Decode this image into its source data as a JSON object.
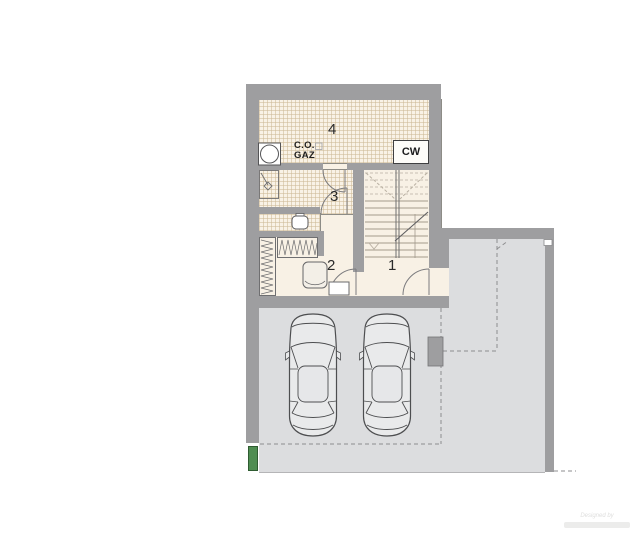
{
  "floor_plan": {
    "rooms": [
      {
        "number": "1"
      },
      {
        "number": "2"
      },
      {
        "number": "3"
      },
      {
        "number": "4"
      }
    ],
    "annotations": {
      "boiler_line1": "C.O.",
      "boiler_line2": "GAZ",
      "water_heater": "CW"
    },
    "watermark": {
      "line1": "Designed by"
    },
    "colors": {
      "wall": "#9e9ea0",
      "floor": "#f8f1e5",
      "tile_line": "#cdb996",
      "driveway": "#dcdddf",
      "accent_green": "#4f8d51",
      "line": "#6f6f71"
    },
    "objects": [
      "gas-boiler-icon",
      "water-heater-box",
      "shower-tray-icon",
      "washbasin-icon",
      "wardrobe-hatch-horizontal",
      "wardrobe-hatch-vertical",
      "stool-icon",
      "cabinet-icon",
      "staircase",
      "door-arc",
      "car-top-view",
      "car-top-view",
      "garage-pillar",
      "driveway-gate-green"
    ]
  }
}
